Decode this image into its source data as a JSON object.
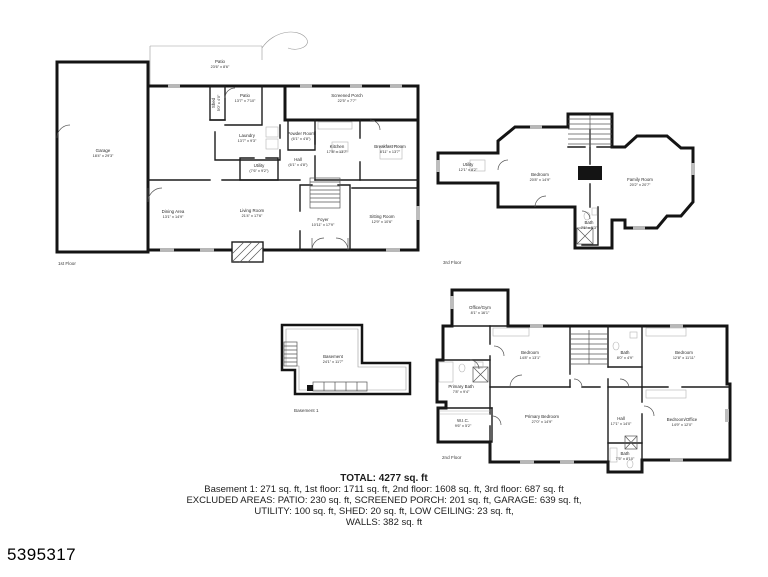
{
  "listing_id": "5395317",
  "summary": {
    "total": "TOTAL: 4277 sq. ft",
    "line1": "Basement 1: 271 sq. ft, 1st floor: 1711 sq. ft, 2nd floor: 1608 sq. ft, 3rd floor: 687 sq. ft",
    "line2": "EXCLUDED AREAS: PATIO: 230 sq. ft, SCREENED PORCH: 201 sq. ft, GARAGE: 639 sq. ft,",
    "line3": "UTILITY: 100 sq. ft, SHED: 20 sq. ft, LOW CEILING: 23 sq. ft,",
    "line4": "WALLS: 382 sq. ft"
  },
  "floors": {
    "first": {
      "label": "1st Floor",
      "rooms": {
        "garage": {
          "name": "Garage",
          "dims": "18'4\" x 29'3\""
        },
        "patio_top": {
          "name": "Patio",
          "dims": "23'6\" x 8'6\""
        },
        "shed": {
          "name": "Shed",
          "dims": "5'0\" x 4'0\""
        },
        "patio": {
          "name": "Patio",
          "dims": "13'7\" x 7'10\""
        },
        "screened_porch": {
          "name": "Screened Porch",
          "dims": "22'5\" x 7'7\""
        },
        "laundry": {
          "name": "Laundry",
          "dims": "13'7\" x 9'3\""
        },
        "powder": {
          "name": "Powder Room",
          "dims": "(6'1\" x 4'8\")"
        },
        "kitchen": {
          "name": "Kitchen",
          "dims": "17'8\" x 13'7\""
        },
        "breakfast": {
          "name": "Breakfast Room",
          "dims": "8'11\" x 13'7\""
        },
        "hall": {
          "name": "Hall",
          "dims": "(6'1\" x 4'8\")"
        },
        "utility": {
          "name": "Utility",
          "dims": "(7'6\" x 9'2\")"
        },
        "dining": {
          "name": "Dining Area",
          "dims": "13'1\" x 14'9\""
        },
        "living": {
          "name": "Living Room",
          "dims": "21'4\" x 17'6\""
        },
        "foyer": {
          "name": "Foyer",
          "dims": "10'11\" x 17'9\""
        },
        "sitting": {
          "name": "Sitting Room",
          "dims": "12'9\" x 10'6\""
        }
      }
    },
    "third": {
      "label": "3rd Floor",
      "rooms": {
        "utility": {
          "name": "Utility",
          "dims": "12'1\" x 8'2\""
        },
        "bedroom": {
          "name": "Bedroom",
          "dims": "20'8\" x 14'9\""
        },
        "family": {
          "name": "Family Room",
          "dims": "20'2\" x 20'7\""
        },
        "bath": {
          "name": "Bath",
          "dims": "7'1\" x 5'3\""
        }
      }
    },
    "basement": {
      "label": "Basement 1",
      "rooms": {
        "basement": {
          "name": "Basement",
          "dims": "24'1\" x 11'7\""
        }
      }
    },
    "second": {
      "label": "2nd Floor",
      "rooms": {
        "office_gym": {
          "name": "Office/Gym",
          "dims": "8'1\" x 16'1\""
        },
        "bedroom_left": {
          "name": "Bedroom",
          "dims": "14'8\" x 13'1\""
        },
        "bath_top": {
          "name": "Bath",
          "dims": "8'0\" x 4'9\""
        },
        "bedroom_right": {
          "name": "Bedroom",
          "dims": "12'8\" x 11'11\""
        },
        "primary_bath": {
          "name": "Primary Bath",
          "dims": "7'8\" x 9'4\""
        },
        "wic": {
          "name": "W.I.C.",
          "dims": "9'6\" x 5'2\""
        },
        "primary_bedroom": {
          "name": "Primary Bedroom",
          "dims": "27'0\" x 14'9\""
        },
        "hall": {
          "name": "Hall",
          "dims": "17'1\" x 14'0\""
        },
        "bedroom_office": {
          "name": "Bedroom/Office",
          "dims": "14'9\" x 12'0\""
        },
        "bath_bottom": {
          "name": "Bath",
          "dims": "7'5\" x 8'10\""
        }
      }
    }
  }
}
